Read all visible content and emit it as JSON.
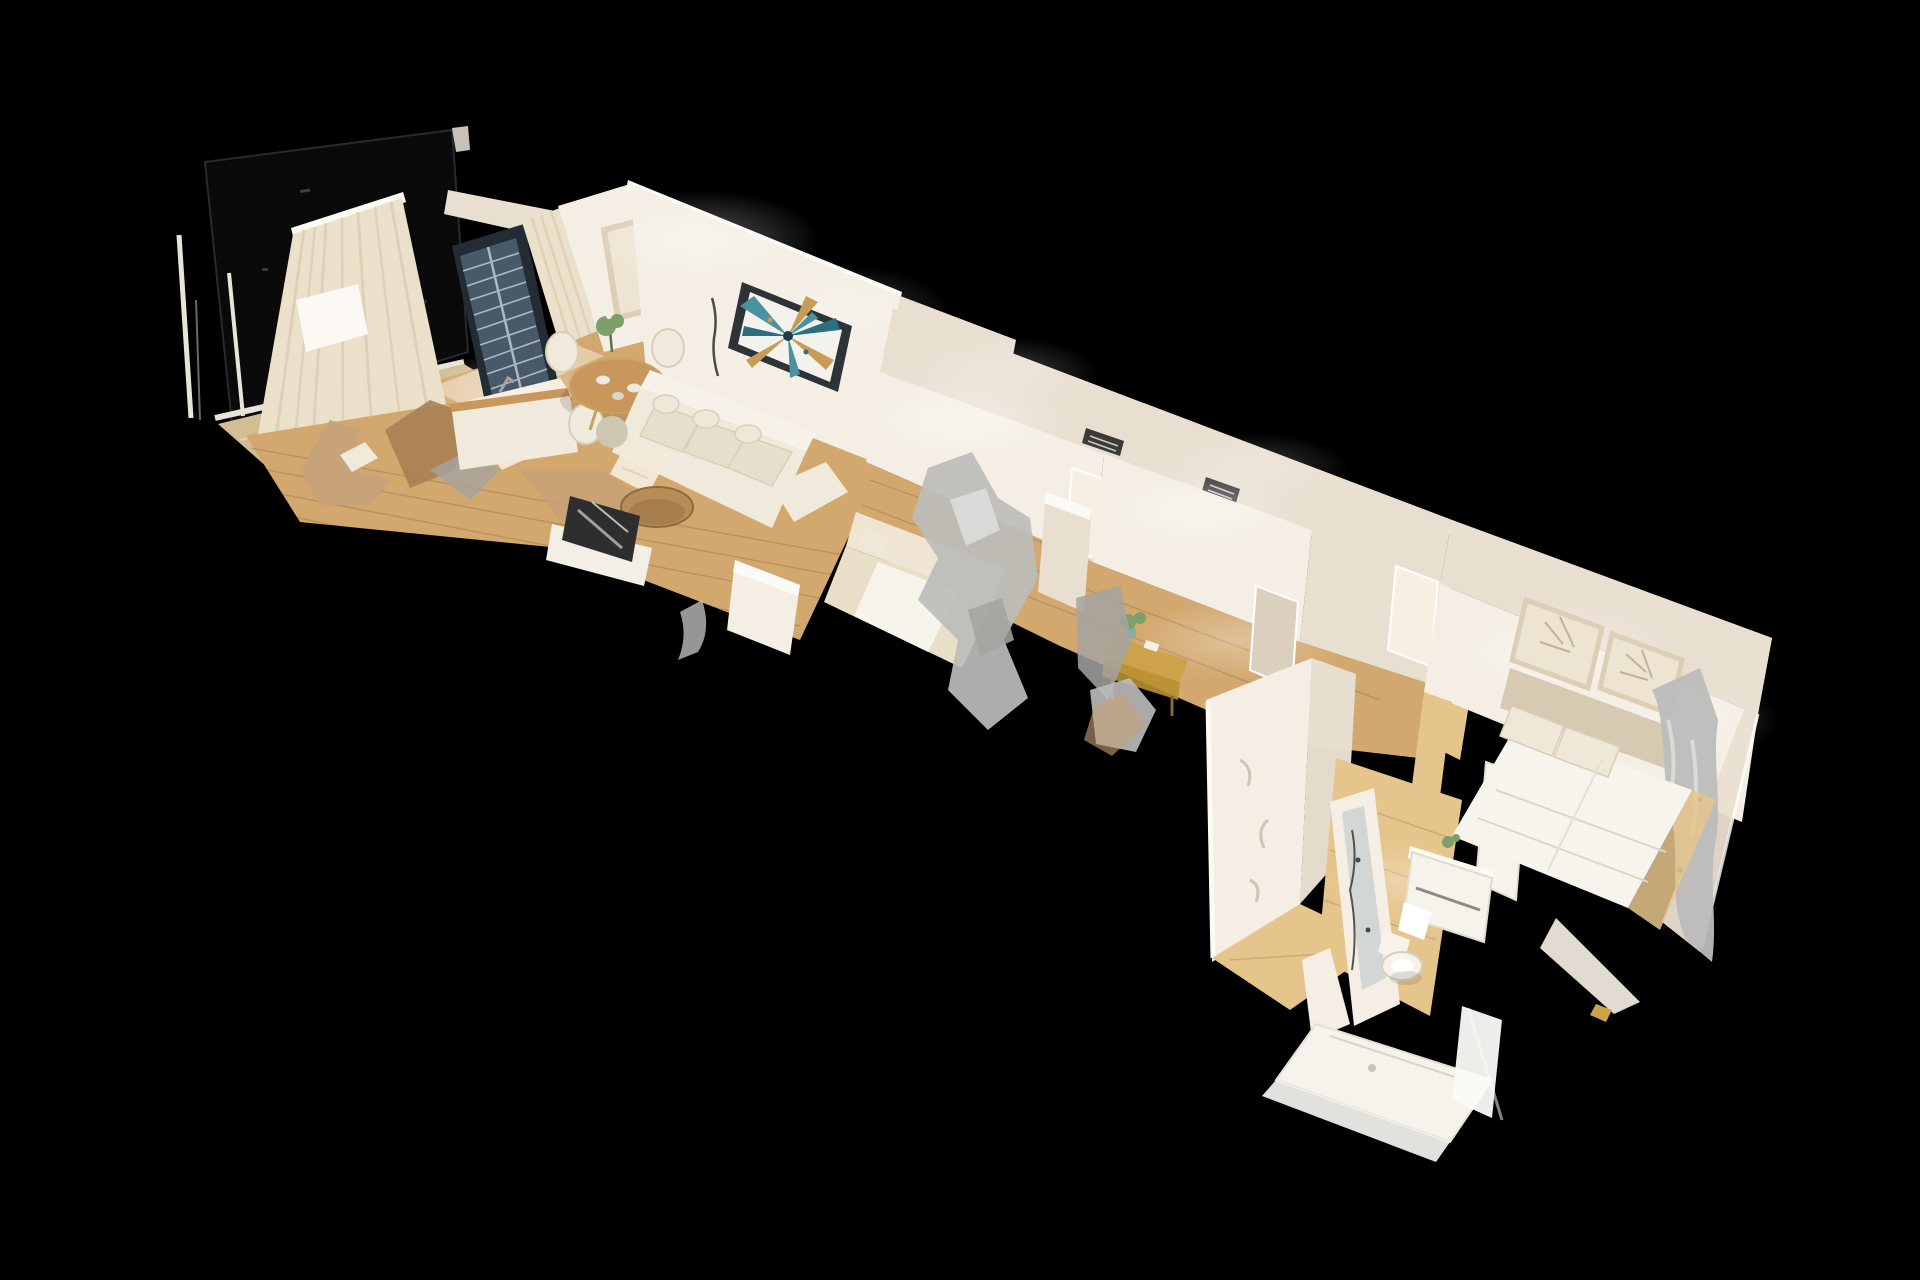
{
  "app": {
    "view": "dollhouse-3d-scan",
    "background": "#000000"
  },
  "palette": {
    "background": "#000000",
    "blackGloss": "#0a0a0a",
    "glossEdge": "#2a2a2a",
    "railWhite": "#e9e4d8",
    "deck": "#d3bd93",
    "floorWood": "#d3a86f",
    "floorWoodLight": "#e6c58d",
    "wallLit": "#f4eee4",
    "wallMid": "#e9dfd1",
    "wallShadow": "#dbcfbe",
    "wallTop": "#fcfaf5",
    "threshold": "#f7f0e2",
    "curtain": "#ebe1cb",
    "curtainStripe": "#d6c7ab",
    "glassFrame": "#232c34",
    "glassPane": "#48596a",
    "glassGrid": "#c7d1d9",
    "emptyFrame": "#dccfb5",
    "emptyFrameInner": "#eee4d2",
    "frameLineArt": "#c4b293",
    "artFrame": "#2d3337",
    "artCanvas": "#f3f2ec",
    "artTeal": "#49929f",
    "artTealDark": "#2c6f80",
    "artGold": "#c99c55",
    "artNavy": "#1e3c4c",
    "sofaCream": "#f0eadd",
    "cushion": "#e7dfcc",
    "cushionShadow": "#d9cfb9",
    "tableWood": "#c9965c",
    "goldLeg": "#c9a35c",
    "coffeeWood": "#b88d55",
    "tvDark": "#2e2e2e",
    "silver": "#bcbcba",
    "silverLight": "#dddddc",
    "grayBlob": "#a5a3a0",
    "clutterTan": "#c7a178",
    "clutterBrown": "#a97f52",
    "daybed": "#e9dfc8",
    "bedWhite": "#f7f4ed",
    "pillow": "#efe8d9",
    "headboard": "#d7cab2",
    "ventDark": "#3a3a38",
    "plantGreen": "#7da06a",
    "plantDark": "#55774a",
    "porcelain": "#f6f3ec",
    "mirror": "#ccd2d1",
    "deskWood": "#cda24a",
    "deskWoodDark": "#b8902f",
    "woodEdge": "#8a6b44"
  },
  "scene": {
    "projection": "isometric-dollhouse",
    "rooms": [
      "balcony",
      "living-dining-kitchen",
      "bedroom-1",
      "study",
      "hallway",
      "bedroom-2",
      "bathroom"
    ],
    "objects": [
      "balcony-railing",
      "wood-deck",
      "sheer-curtains",
      "glass-grid-door",
      "empty-wall-frame",
      "abstract-wall-art",
      "dining-table-set",
      "house-plant",
      "kitchen-island",
      "sectional-sofa",
      "round-coffee-table",
      "tv-sideboard",
      "floor-lamp",
      "scan-artifact-debris",
      "daybed",
      "hvac-vent",
      "doorway",
      "study-desk",
      "desk-chair-artifact",
      "partition-wall",
      "framed-line-art",
      "bed-headboard",
      "double-bed",
      "radiator-curtain-artifact",
      "mirror-wall",
      "bathroom-vanity",
      "toilet",
      "shower-tray",
      "wood-flooring"
    ]
  }
}
